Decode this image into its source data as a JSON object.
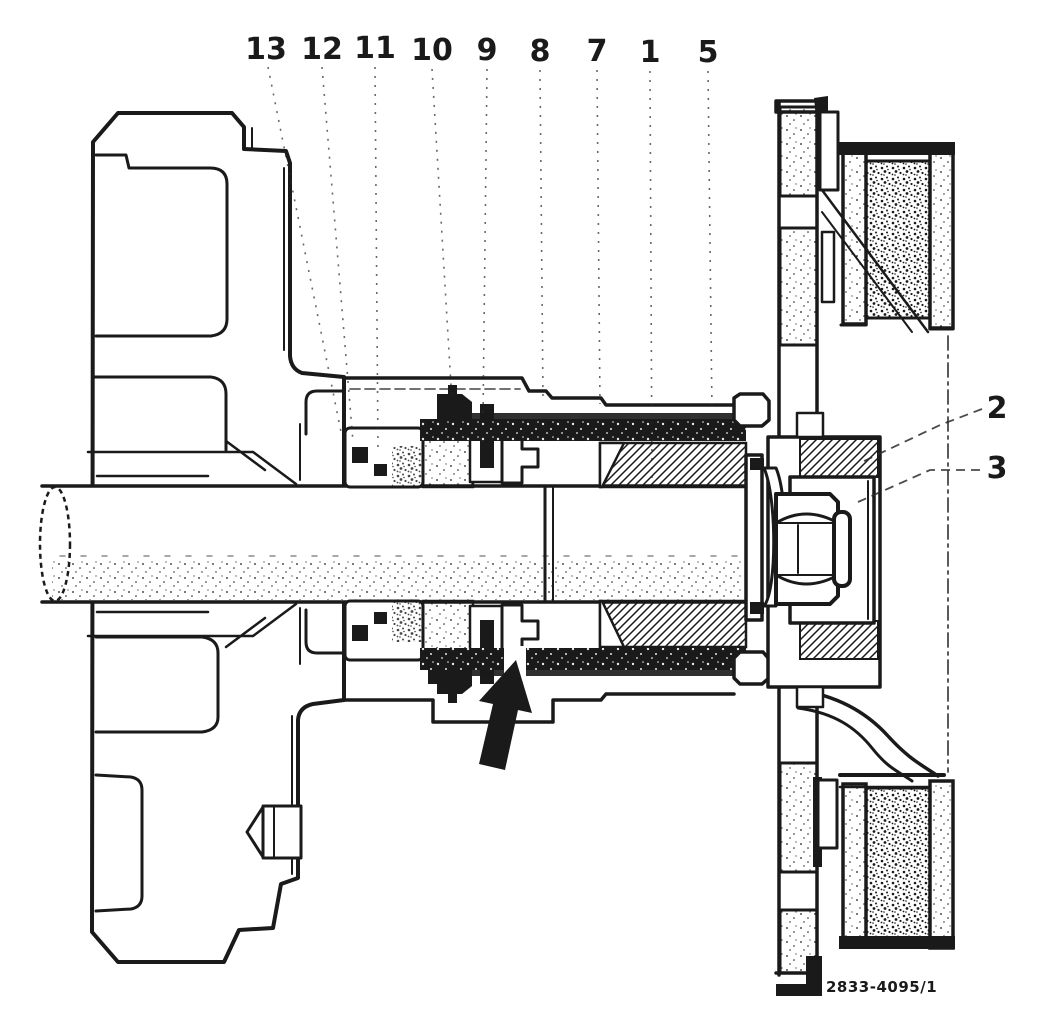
{
  "figure": {
    "callouts_top": [
      {
        "label": "13"
      },
      {
        "label": "12"
      },
      {
        "label": "11"
      },
      {
        "label": "10"
      },
      {
        "label": "9"
      },
      {
        "label": "8"
      },
      {
        "label": "7"
      },
      {
        "label": "1"
      },
      {
        "label": "5"
      }
    ],
    "callouts_right": [
      {
        "label": "2"
      },
      {
        "label": "3"
      }
    ],
    "reference_code": "2833-4095/1"
  },
  "colors": {
    "ink": "#1a1a1a",
    "paper": "#ffffff"
  }
}
